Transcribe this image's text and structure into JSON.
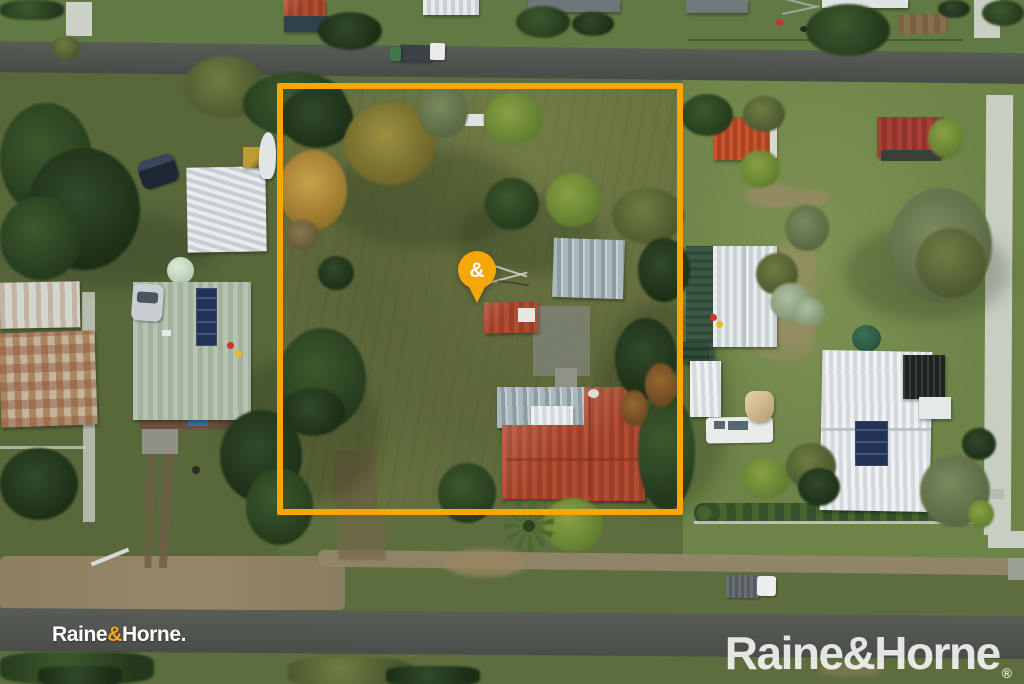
{
  "image": {
    "description": "Aerial drone photo of a grassy residential property outlined in gold with a location pin, streets above and below, neighbouring houses either side",
    "width_px": 1024,
    "height_px": 684
  },
  "theme": {
    "brand_gold": "#F9A602",
    "pin_gold": "#F5A70A",
    "logo_amp_gold": "#F5A623",
    "logo_white": "#FFFFFF",
    "watermark_white": "rgba(255,255,255,0.85)"
  },
  "overlay": {
    "boundary": {
      "shape": "rectangle",
      "color": "#F9A602",
      "stroke_px": 6
    },
    "pin": {
      "symbol": "&"
    }
  },
  "branding": {
    "small_logo": {
      "part1": "Raine",
      "amp": "&",
      "part2": "Horne",
      "period": "."
    },
    "watermark": {
      "part1": "Raine",
      "amp": "&",
      "part2": "Horne",
      "registered": "®"
    }
  }
}
